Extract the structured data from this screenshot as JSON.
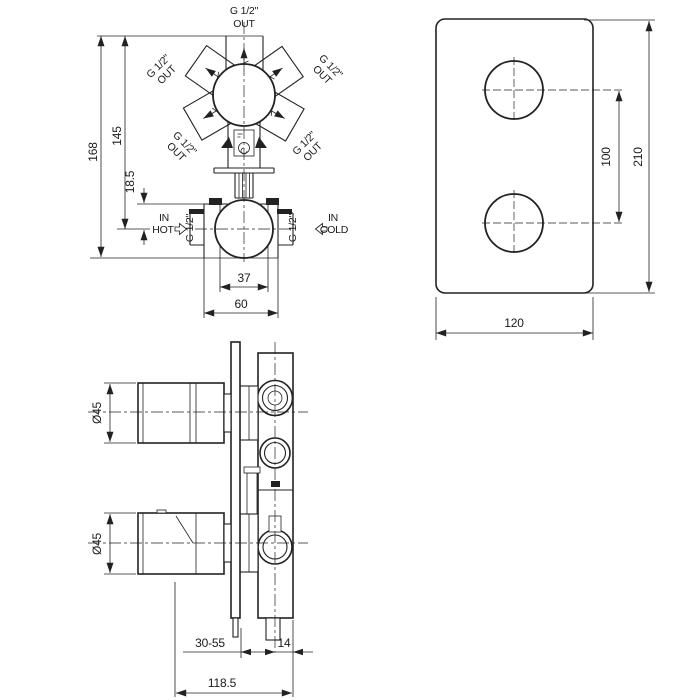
{
  "front_view": {
    "outlet_top": {
      "size": "G 1/2\"",
      "dir": "OUT"
    },
    "outlet_upper_left": {
      "size": "G 1/2\"",
      "dir": "OUT"
    },
    "outlet_upper_right": {
      "size": "G 1/2\"",
      "dir": "OUT"
    },
    "outlet_lower_left": {
      "size": "G 1/2\"",
      "dir": "OUT"
    },
    "outlet_lower_right": {
      "size": "G 1/2\"",
      "dir": "OUT"
    },
    "inlet_hot": {
      "line1": "IN",
      "line2": "HOT",
      "size": "G 1/2\""
    },
    "inlet_cold": {
      "line1": "IN",
      "line2": "COLD",
      "size": "G 1/2\""
    },
    "dims": {
      "height_total": "168",
      "height_to_inlet": "145",
      "inlet_offset": "18.5",
      "cartridge_width": "37",
      "housing_width": "60"
    }
  },
  "plate_view": {
    "dims": {
      "hole_spacing": "100",
      "plate_height": "210",
      "plate_width": "120"
    }
  },
  "side_view": {
    "dims": {
      "knob_top_diameter": "Ø45",
      "knob_bottom_diameter": "Ø45",
      "install_depth_range": "30-55",
      "center_offset": "14",
      "total_depth": "118.5"
    }
  },
  "colors": {
    "line": "#222222",
    "background": "#ffffff"
  }
}
